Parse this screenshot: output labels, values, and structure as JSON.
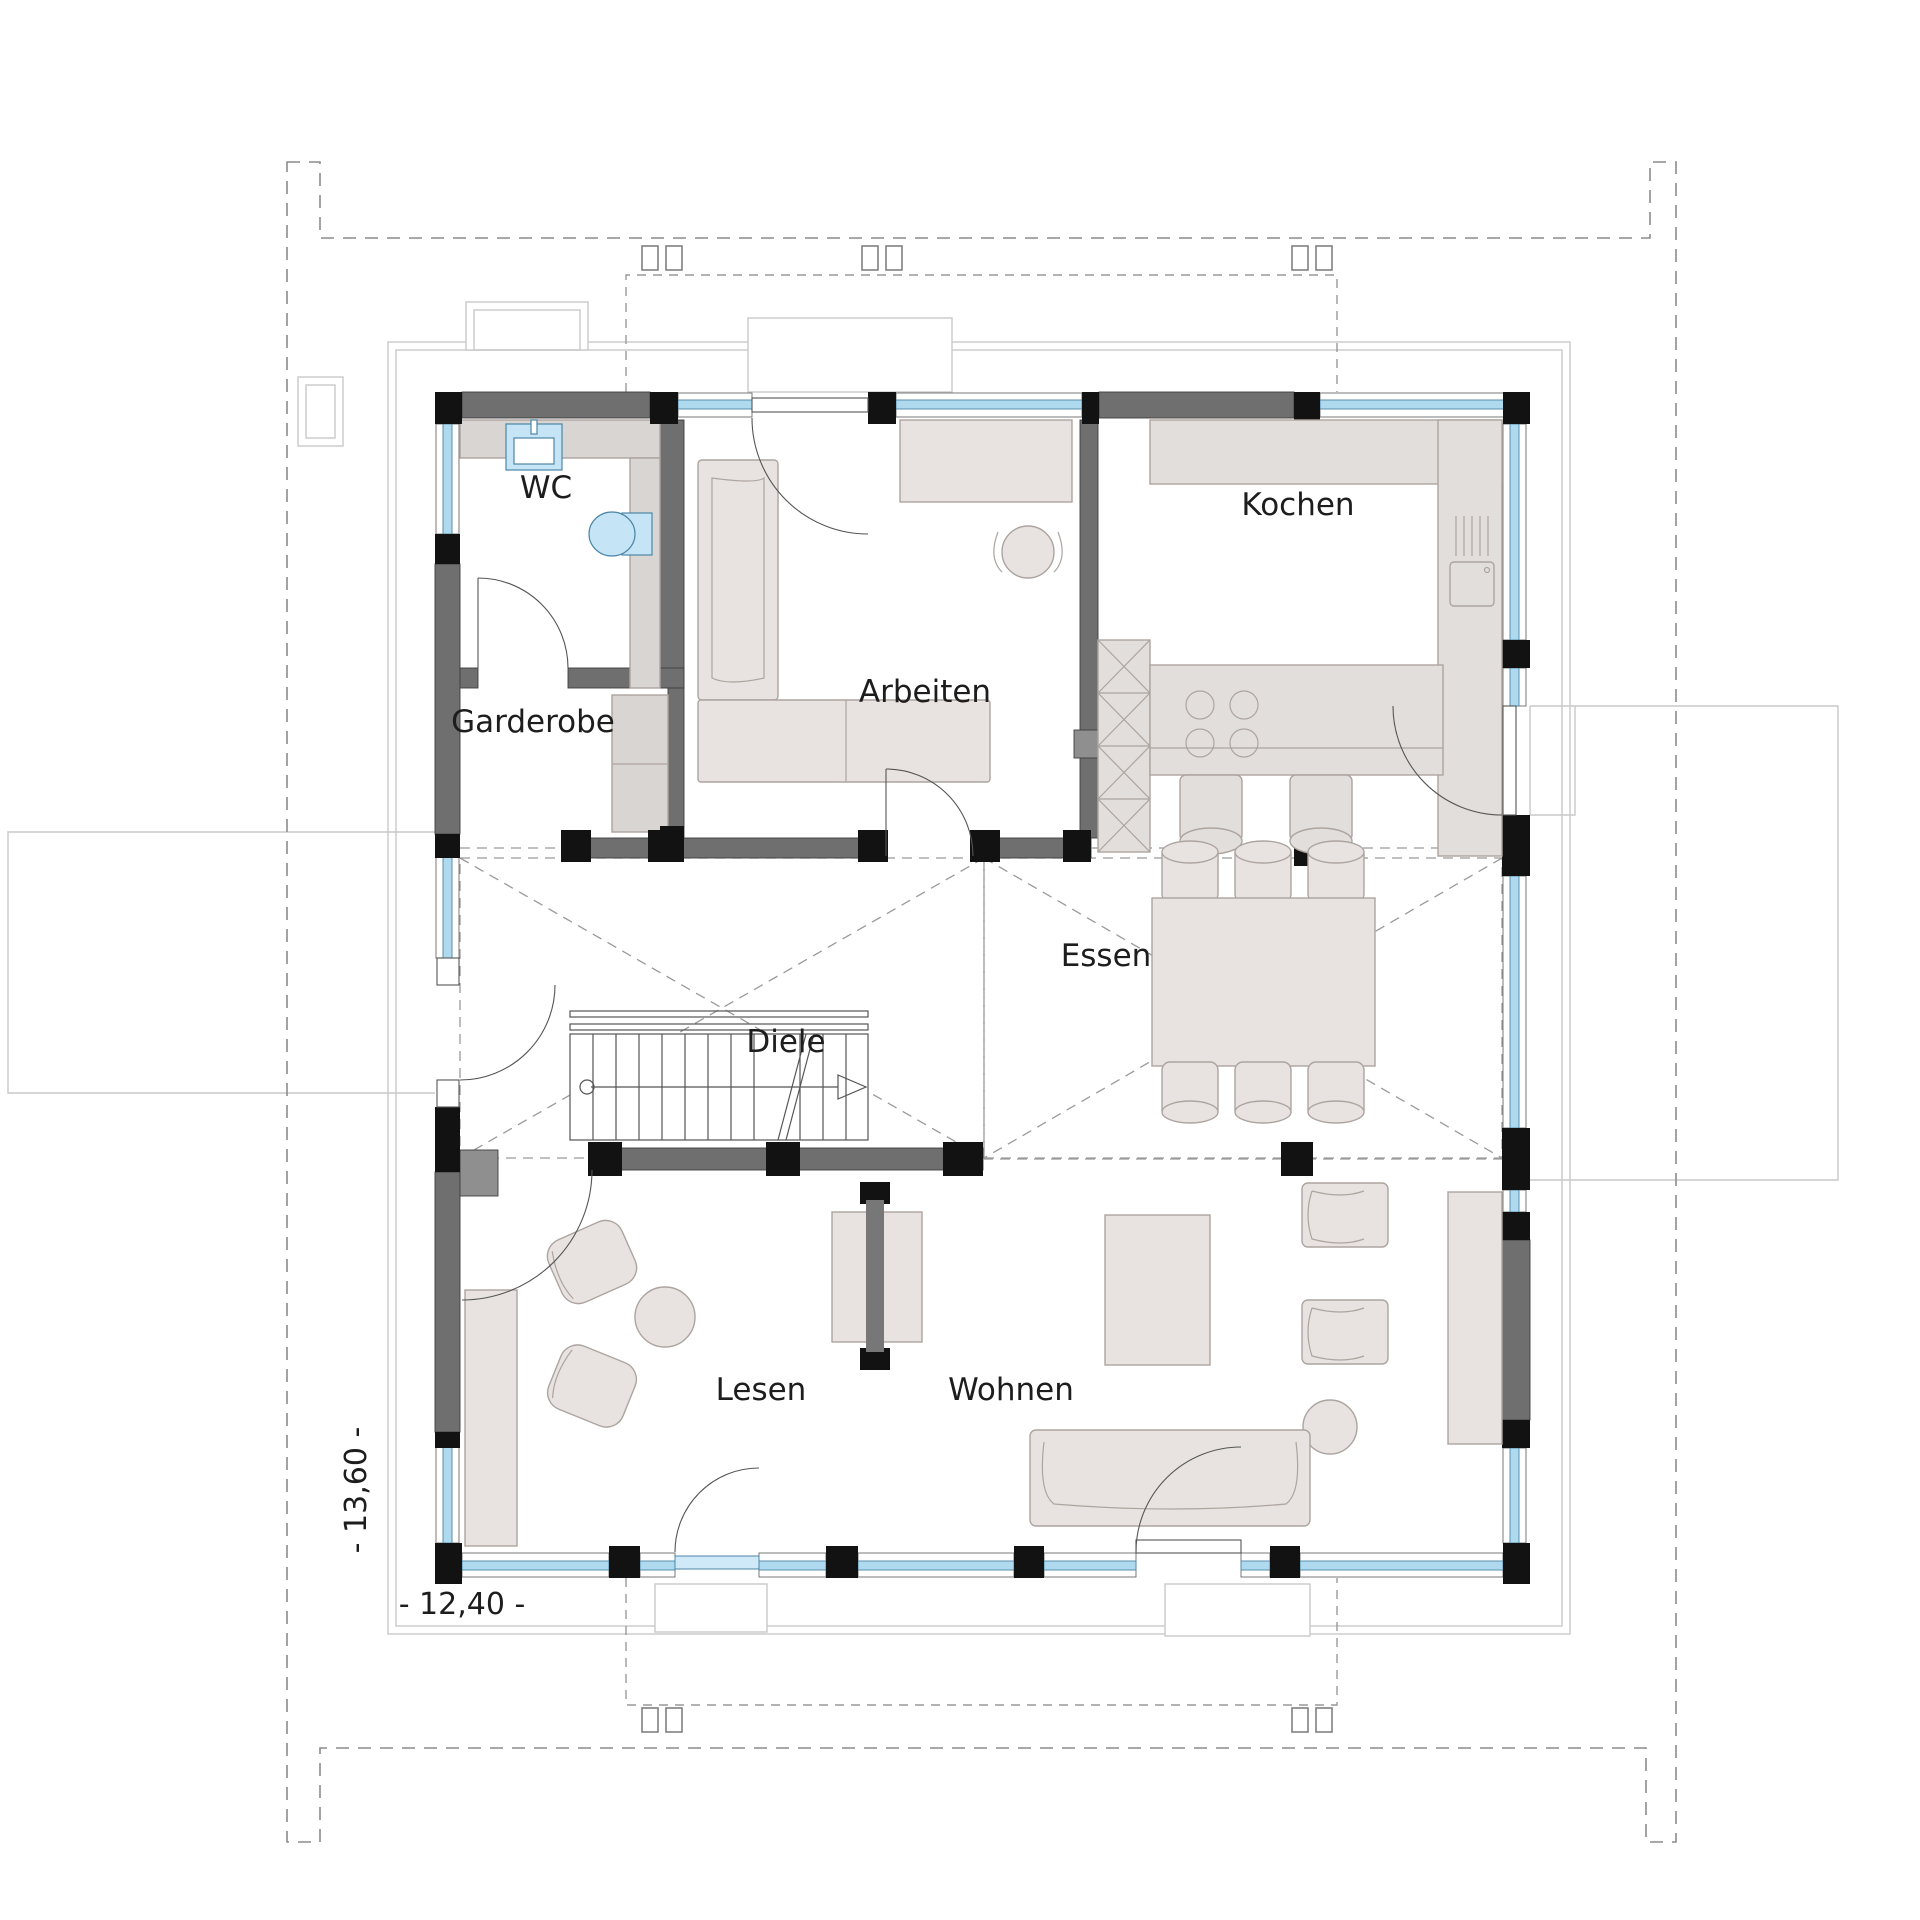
{
  "plan": {
    "type": "floor-plan",
    "level": "Erdgeschoss"
  },
  "rooms": {
    "wc": {
      "label": "WC"
    },
    "garderobe": {
      "label": "Garderobe"
    },
    "arbeiten": {
      "label": "Arbeiten"
    },
    "kochen": {
      "label": "Kochen"
    },
    "diele": {
      "label": "Diele"
    },
    "essen": {
      "label": "Essen"
    },
    "lesen": {
      "label": "Lesen"
    },
    "wohnen": {
      "label": "Wohnen"
    }
  },
  "dimensions": {
    "width_label": "- 12,40 -",
    "height_label": "- 13,60 -"
  },
  "colors": {
    "wall": "#6f6f6f",
    "column": "#121212",
    "glass": "#aed9ef",
    "furniture": "#e8e3e0",
    "counter": "#e2dedb",
    "light": "#d9d5d3",
    "block": "#8f8f8f",
    "sanitary": "#c5e4f5",
    "text": "#1d1d1d"
  }
}
